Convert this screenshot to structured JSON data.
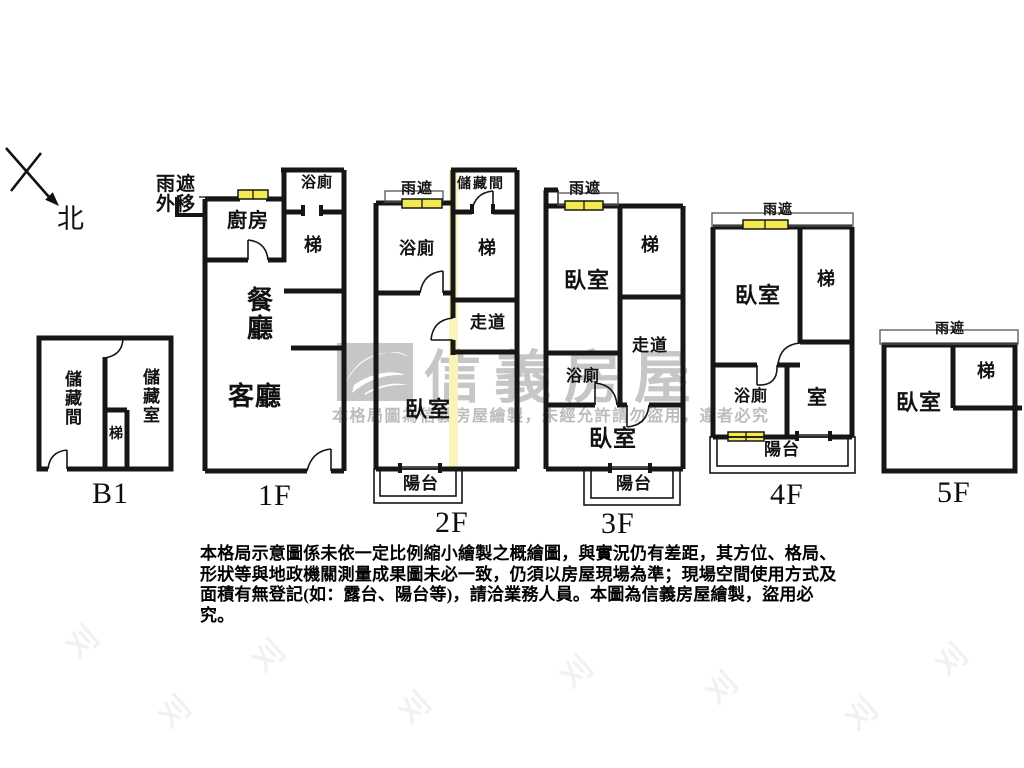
{
  "compass": {
    "north_label": "北"
  },
  "callout": {
    "line1": "雨遮",
    "line2": "外移"
  },
  "floors": {
    "b1": {
      "label": "B1",
      "rooms": {
        "storage1": "儲藏間",
        "storage2": "儲藏室",
        "stairs": "梯"
      }
    },
    "f1": {
      "label": "1F",
      "rooms": {
        "bath": "浴廁",
        "kitchen": "廚房",
        "stairs": "梯",
        "dining": "餐廳",
        "living": "客廳"
      }
    },
    "f2": {
      "label": "2F",
      "rain_shade": "雨遮",
      "rooms": {
        "storage": "儲藏間",
        "bath": "浴廁",
        "stairs": "梯",
        "corridor": "走道",
        "bedroom": "臥室",
        "balcony": "陽台"
      }
    },
    "f3": {
      "label": "3F",
      "rain_shade": "雨遮",
      "rooms": {
        "bedroom_top": "臥室",
        "stairs": "梯",
        "corridor": "走道",
        "bath": "浴廁",
        "bedroom_bottom": "臥室",
        "balcony": "陽台"
      }
    },
    "f4": {
      "label": "4F",
      "rain_shade": "雨遮",
      "rooms": {
        "bedroom": "臥室",
        "stairs": "梯",
        "bath": "浴廁",
        "room": "室",
        "balcony": "陽台"
      }
    },
    "f5": {
      "label": "5F",
      "rain_shade": "雨遮",
      "rooms": {
        "bedroom": "臥室",
        "stairs": "梯"
      }
    }
  },
  "watermark": {
    "brand": "信義房屋",
    "notice": "本格局圖為信義房屋繪製，未經允許請勿盜用，違者必究"
  },
  "disclaimer": {
    "line1": "本格局示意圖係未依一定比例縮小繪製之概繪圖，與實況仍有差距，其方位、格局、",
    "line2": "形狀等與地政機關測量成果圖未必一致，仍須以房屋現場為準；現場空間使用方式及",
    "line3": "面積有無登記(如：露台、陽台等)，請洽業務人員。本圖為信義房屋繪製，盜用必究。"
  },
  "colors": {
    "wall": "#161616",
    "rain_shade_fill": "#f2ea4e",
    "highlight_strip": "#f8f4bb",
    "watermark_grey": "#c6c6c6",
    "notice_grey": "#bcbcbc"
  }
}
